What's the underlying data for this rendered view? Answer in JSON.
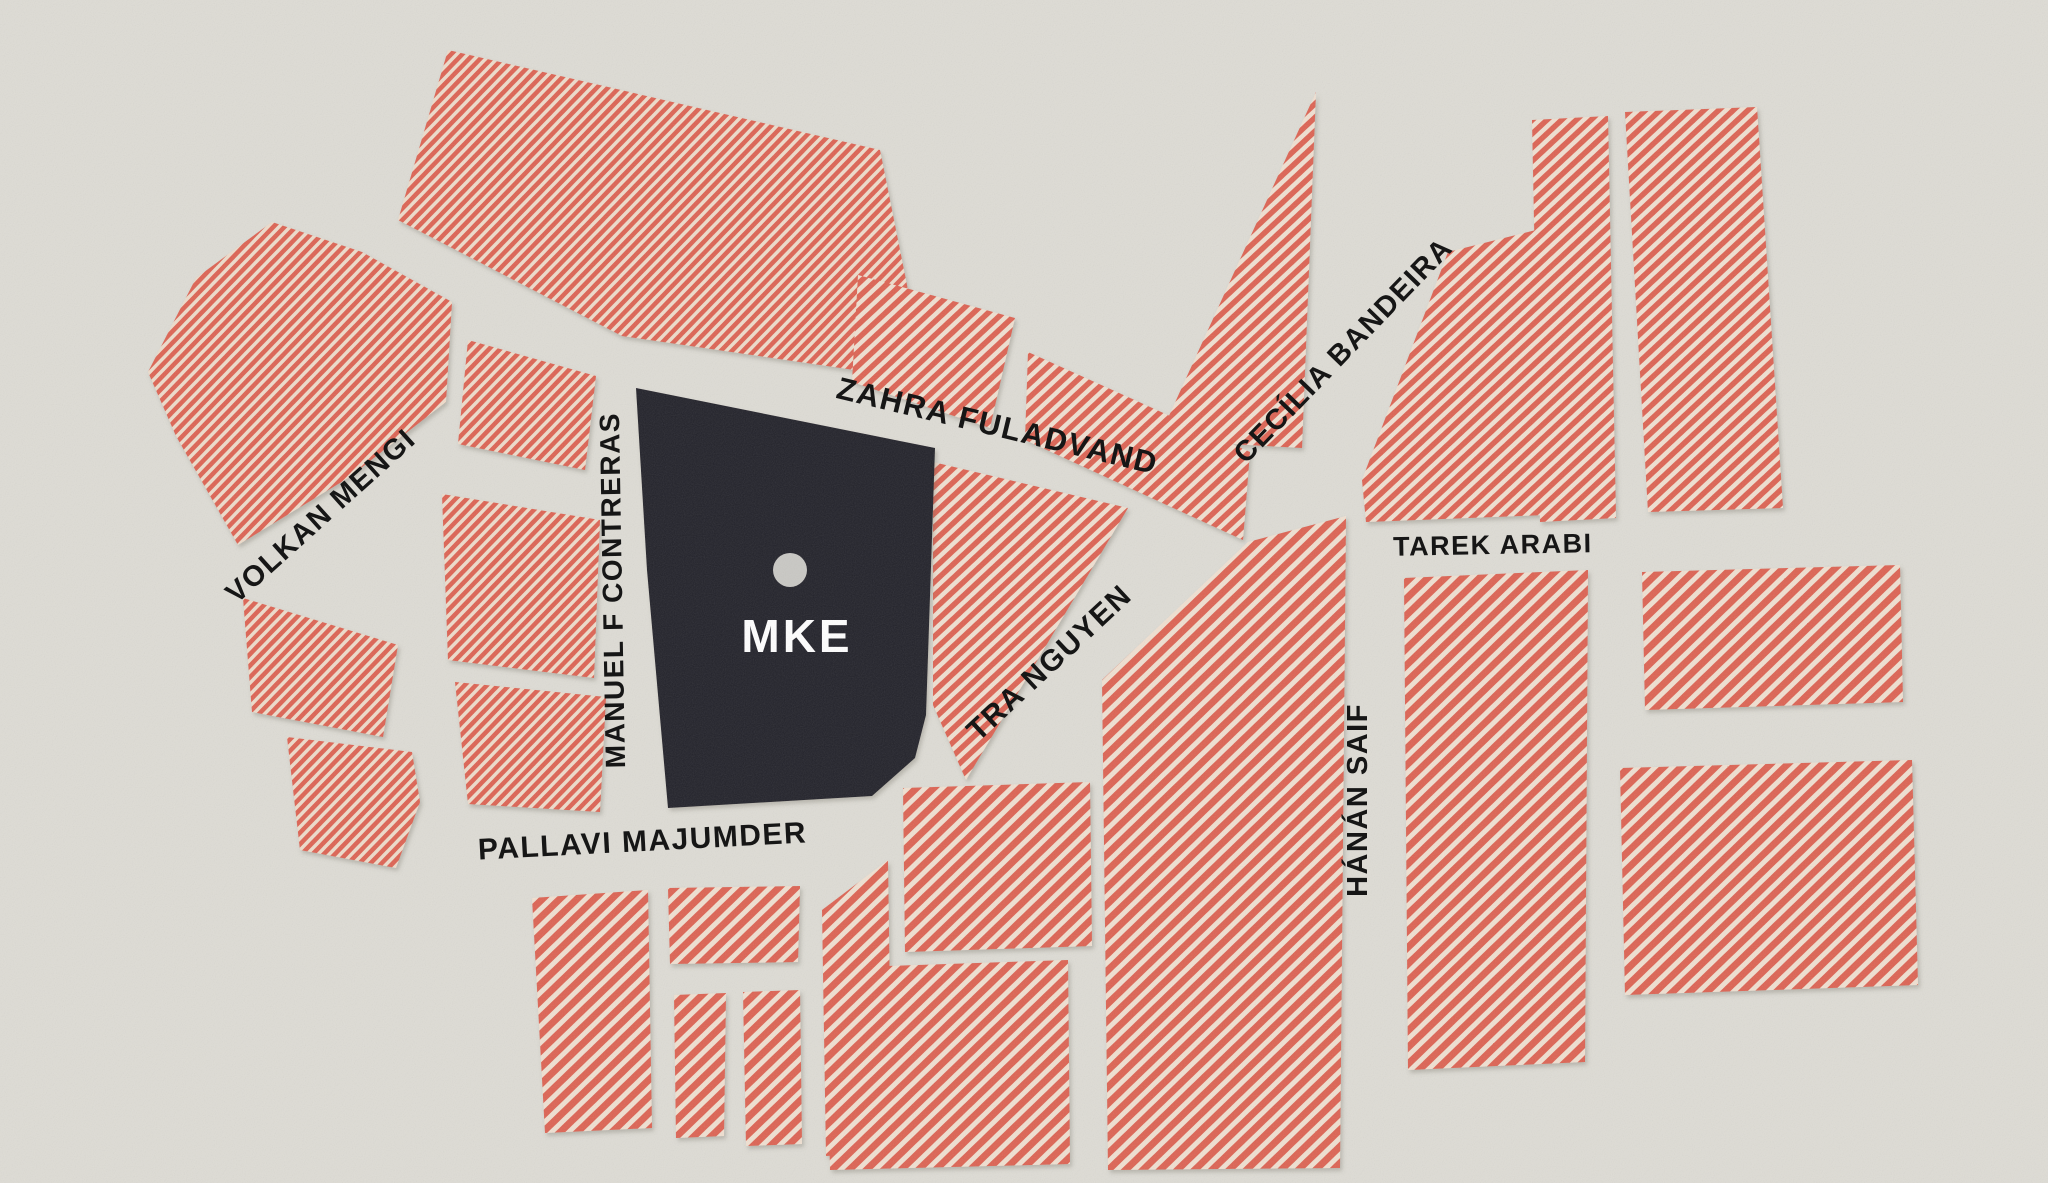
{
  "map": {
    "background_color": "#dedcd5",
    "stripe_color": "#dd6452",
    "stripe_gap_color": "#f0e0d1",
    "stripe_gap_color_fine": "#eedcCb",
    "label_color": "#161616",
    "venue": {
      "label": "MKE",
      "block_color": "#232029",
      "marker_color": "#c9c8c4",
      "label_color": "#ffffff",
      "points": "636,388 935,448 926,715 915,758 872,796 668,808 647,570",
      "marker": {
        "cx": 790,
        "cy": 570,
        "r": 17
      },
      "label_x": 797,
      "label_y": 652,
      "label_size": 46,
      "label_spacing": 3
    },
    "street_labels": [
      {
        "id": "volkan-mengi",
        "text": "VOLKAN MENGI",
        "x": 327,
        "y": 523,
        "rotate": -42,
        "size": 29
      },
      {
        "id": "manuel-f-contreras",
        "text": "MANUEL F CONTRERAS",
        "x": 622,
        "y": 590,
        "rotate": -91,
        "size": 28
      },
      {
        "id": "zahra-fuladvand",
        "text": "ZAHRA  FULADVAND",
        "x": 995,
        "y": 436,
        "rotate": 13.5,
        "size": 31
      },
      {
        "id": "cecilia-bandeira",
        "text": "CECÍLIA BANDEIRA",
        "x": 1350,
        "y": 357,
        "rotate": -46,
        "size": 29
      },
      {
        "id": "tarek-arabi",
        "text": "TAREK ARABI",
        "x": 1493,
        "y": 554,
        "rotate": -1,
        "size": 27
      },
      {
        "id": "tra-nguyen",
        "text": "TRA NGUYEN",
        "x": 1056,
        "y": 670,
        "rotate": -43,
        "size": 30
      },
      {
        "id": "hanan-saif",
        "text": "HÁNÁN SAIF",
        "x": 1367,
        "y": 800,
        "rotate": -90,
        "size": 29
      },
      {
        "id": "pallavi-majumder",
        "text": "PALLAVI MAJUMDER",
        "x": 643,
        "y": 851,
        "rotate": -3,
        "size": 30
      }
    ],
    "blocks": [
      {
        "pattern": "fine",
        "points": "272,222 362,252 452,302 446,402 348,478 238,545 176,436 148,372 196,278"
      },
      {
        "pattern": "fine",
        "points": "243,598 398,645 383,737 252,712"
      },
      {
        "pattern": "fine",
        "points": "287,737 412,752 420,802 396,868 300,850"
      },
      {
        "pattern": "fine",
        "points": "468,340 596,376 585,470 458,444"
      },
      {
        "pattern": "fine",
        "points": "442,494 600,520 594,678 448,660"
      },
      {
        "pattern": "fine",
        "points": "455,682 606,697 600,812 468,804"
      },
      {
        "pattern": "fine",
        "points": "448,50 880,150 908,290 868,372 622,336 398,220"
      },
      {
        "pattern": "med",
        "points": "858,275 1015,318 990,428 852,382"
      },
      {
        "pattern": "med",
        "points": "1028,352 1250,452 1243,540 1025,440"
      },
      {
        "pattern": "med",
        "points": "1316,92 1302,448 1158,440"
      },
      {
        "pattern": "med",
        "points": "933,462 1128,508 966,780 933,705"
      },
      {
        "pattern": "bold",
        "points": "1248,542 1346,516 1340,1168 1108,1170 1102,680"
      },
      {
        "pattern": "med",
        "points": "1448,252 1536,230 1546,515 1366,522 1362,480"
      },
      {
        "pattern": "med",
        "points": "1532,120 1608,116 1616,518 1540,522"
      },
      {
        "pattern": "med",
        "points": "1625,112 1757,107 1783,508 1648,512"
      },
      {
        "pattern": "bold",
        "points": "1404,578 1588,570 1585,1062 1408,1070"
      },
      {
        "pattern": "bold",
        "points": "1642,572 1900,565 1903,702 1645,710"
      },
      {
        "pattern": "bold",
        "points": "1620,768 1912,760 1918,985 1625,995"
      },
      {
        "pattern": "bold",
        "points": "532,898 648,890 652,1128 545,1133"
      },
      {
        "pattern": "bold",
        "points": "668,888 800,886 798,962 670,964"
      },
      {
        "pattern": "bold",
        "points": "674,995 726,993 724,1136 676,1138"
      },
      {
        "pattern": "bold",
        "points": "743,992 800,990 802,1144 746,1146"
      },
      {
        "pattern": "bold",
        "points": "822,910 888,860 892,1152 826,1156"
      },
      {
        "pattern": "bold",
        "points": "903,788 1090,782 1092,946 905,952"
      },
      {
        "pattern": "bold",
        "points": "826,968 1068,960 1070,1164 830,1170"
      }
    ]
  }
}
